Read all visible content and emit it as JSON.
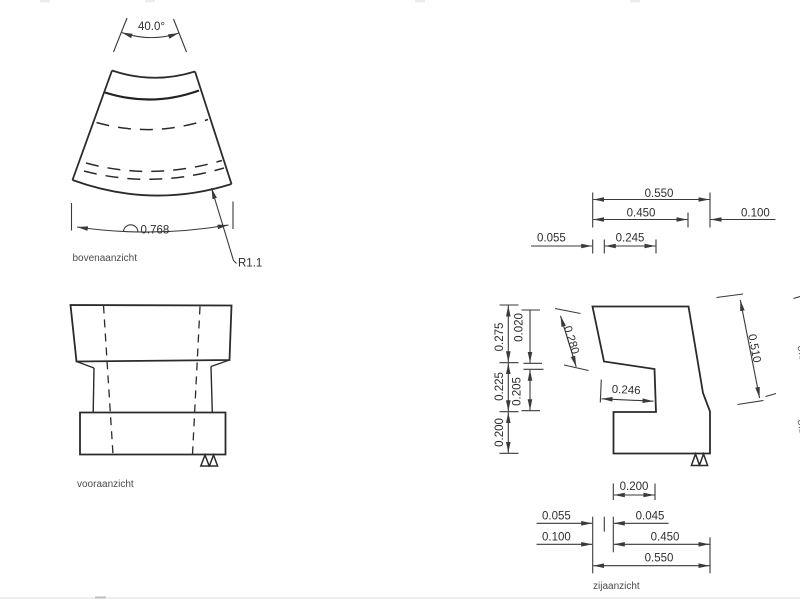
{
  "drawing": {
    "views": {
      "top": {
        "label": "bovenaanzicht",
        "angle": "40.0°",
        "arc_length": "0.768",
        "radius": "R1.1"
      },
      "front": {
        "label": "vooraanzicht"
      },
      "side": {
        "label": "zijaanzicht",
        "top_dims": {
          "w_total": "0.550",
          "w_upper": "0.450",
          "w_offset": "0.100",
          "w_a": "0.055",
          "w_b": "0.245"
        },
        "left_dims": {
          "h_top": "0.275",
          "h_step": "0.020",
          "h_mid": "0.225",
          "h_notch": "0.205",
          "h_base": "0.200"
        },
        "aligned_dims": {
          "edge_left": "0.280",
          "edge_right": "0.510",
          "notch_depth": "0.246"
        },
        "bottom_dims": {
          "b_notch": "0.200",
          "b_a": "0.055",
          "b_b": "0.045",
          "b_c": "0.100",
          "b_lower": "0.450",
          "b_total": "0.550"
        },
        "clipped_dims": {
          "p1": "0.500",
          "p2": "0.200"
        }
      }
    },
    "colors": {
      "outline": "#2b2b2b",
      "dimension": "#3a3a3a",
      "background": "#ffffff"
    }
  }
}
